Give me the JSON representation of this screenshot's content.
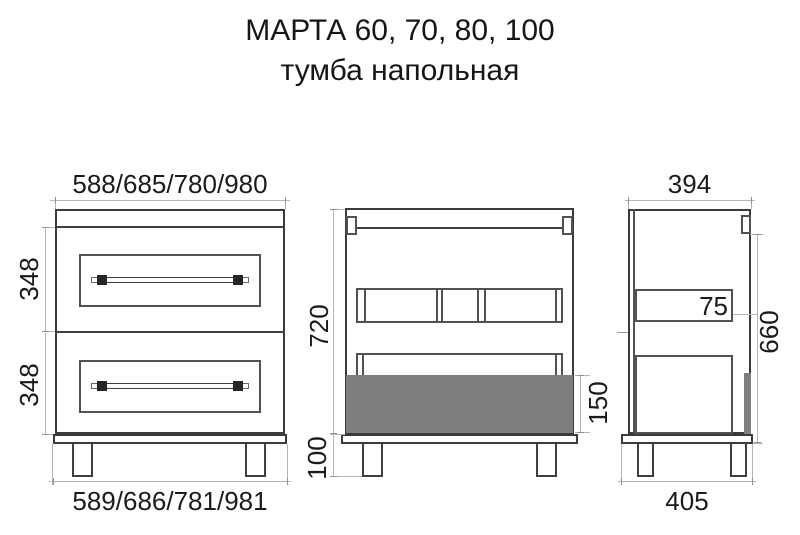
{
  "title": {
    "line1": "МАРТА 60, 70, 80, 100",
    "line2": "тумба напольная"
  },
  "views": {
    "front": {
      "label": "front-view",
      "dim_top": "588/685/780/980",
      "dim_drawer1": "348",
      "dim_drawer2": "348",
      "dim_bottom": "589/686/781/981"
    },
    "back": {
      "label": "back-section-view",
      "dim_height": "720",
      "dim_legs": "100",
      "dim_drawer_depth": "150"
    },
    "side": {
      "label": "side-view",
      "dim_top": "394",
      "dim_rail": "75",
      "dim_height": "660",
      "dim_bottom": "405"
    }
  },
  "colors": {
    "outline": "#3b3b3b",
    "inner_outline": "#515151",
    "dimension_line": "#b6b6b6",
    "gray_fill": "#7e7e7e",
    "text": "#1b1b1b"
  }
}
